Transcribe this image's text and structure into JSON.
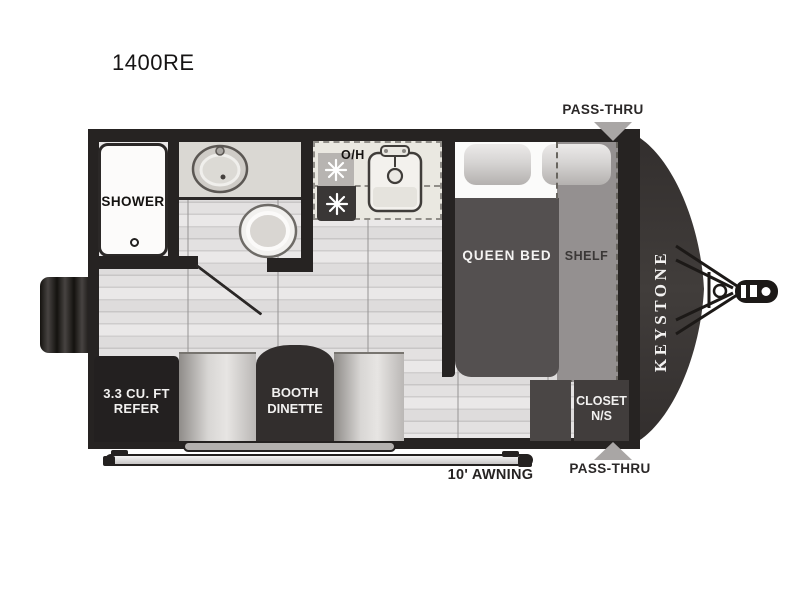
{
  "floorplan": {
    "model": "1400RE",
    "brand": "KEYSTONE",
    "rooms": {
      "shower": {
        "label": "SHOWER"
      },
      "kitchen": {
        "overhead_label": "O/H"
      },
      "bedroom": {
        "bed_label": "QUEEN BED",
        "shelf_label": "SHELF"
      },
      "refrigerator": {
        "line1": "3.3 CU. FT",
        "line2": "REFER"
      },
      "dinette": {
        "line1": "BOOTH",
        "line2": "DINETTE"
      },
      "closet": {
        "line1": "CLOSET",
        "line2": "N/S"
      }
    },
    "callouts": {
      "pass_thru_top": "PASS-THRU",
      "pass_thru_bottom": "PASS-THRU",
      "awning": "10' AWNING"
    },
    "fixture_icons": [
      "shower-drain-icon",
      "bathroom-sink-icon",
      "toilet-icon",
      "burner-icon",
      "kitchen-sink-icon",
      "hitch-icon",
      "pass-thru-arrow-icon"
    ],
    "colors": {
      "wall": "#262322",
      "floor": "#dfdddd",
      "bed": "#545050",
      "shelf": "#949090",
      "cabinet_dark": "#232020",
      "front_cap": "#3a3534",
      "arrow_gray": "#a9a6a5",
      "counter": "#eae8e1",
      "label_dark": "#2b2828",
      "label_light": "#f2f1f0"
    }
  }
}
